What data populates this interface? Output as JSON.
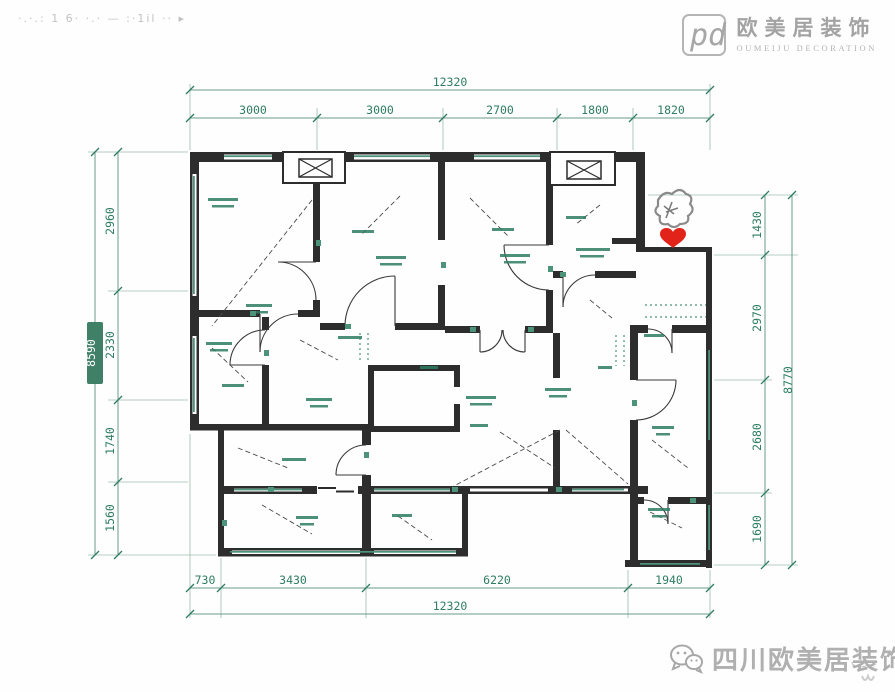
{
  "watermarks": {
    "top_left": "·.·.: 1 6· ·.· —   :·1il ·· ▸"
  },
  "logo": {
    "cn": "欧美居装饰",
    "en": "OUMEIJU DECORATION"
  },
  "footer": {
    "wechat_text": "四川欧美居装饰"
  },
  "plan": {
    "dimensions": {
      "top": {
        "total": "12320",
        "segments": [
          "3000",
          "3000",
          "2700",
          "1800",
          "1820"
        ]
      },
      "bottom": {
        "total": "12320",
        "segments": [
          "730",
          "3430",
          "6220",
          "1940"
        ]
      },
      "left": {
        "total": "8590",
        "segments": [
          "2960",
          "2330",
          "1740",
          "1560"
        ]
      },
      "right": {
        "total": "8770",
        "segments": [
          "1430",
          "2970",
          "2680",
          "1690"
        ]
      }
    },
    "colors": {
      "wall": "#2d2d2d",
      "annotation_green": "#2e7d63",
      "dimension_green": "#2e7d63",
      "heart_red": "#e2231a",
      "logo_grey": "#a3a3a3"
    }
  }
}
